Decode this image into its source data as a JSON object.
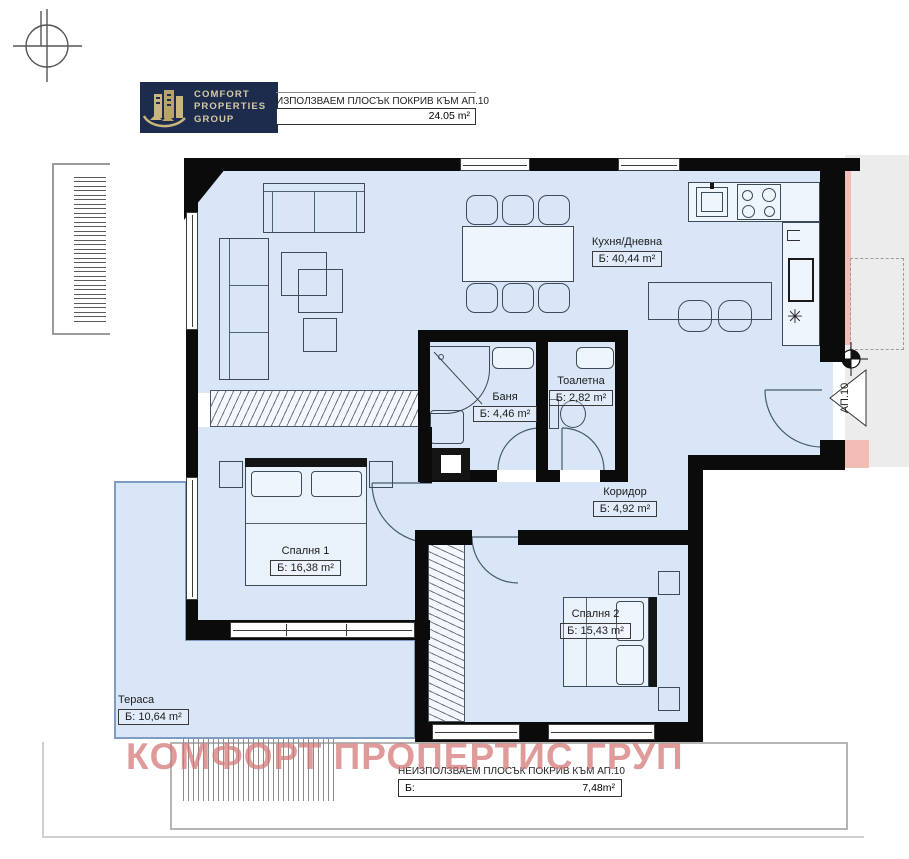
{
  "logo": {
    "line1": "COMFORT",
    "line2": "PROPERTIES",
    "line3": "GROUP",
    "bg": "#1d2b4d",
    "accent": "#c9b67e"
  },
  "roof_top": {
    "label": "ИЗПОЛЗВАЕМ ПЛОСЪК ПОКРИВ КЪМ АП.10",
    "area": "24.05 m²"
  },
  "roof_bottom": {
    "label": "НЕИЗПОЛЗВАЕМ ПЛОСЪК ПОКРИВ КЪМ АП.10",
    "prefix": "Б:",
    "area": "7,48m²"
  },
  "watermark": {
    "text": "КОМФОРТ ПРОПЕРТИС ГРУП",
    "color": "#d27373"
  },
  "apartment": {
    "tag": "АП.10"
  },
  "rooms": [
    {
      "id": "kitchen",
      "name": "Кухня/Дневна",
      "area": "Б: 40,44 m²"
    },
    {
      "id": "bath",
      "name": "Баня",
      "area": "Б: 4,46 m²"
    },
    {
      "id": "toilet",
      "name": "Тоалетна",
      "area": "Б: 2,82 m²"
    },
    {
      "id": "corridor",
      "name": "Коридор",
      "area": "Б: 4,92 m²"
    },
    {
      "id": "bedroom1",
      "name": "Спалня 1",
      "area": "Б: 16,38 m²"
    },
    {
      "id": "bedroom2",
      "name": "Спалня 2",
      "area": "Б: 15,43 m²"
    },
    {
      "id": "terrace",
      "name": "Тераса",
      "area": "Б: 10,64 m²"
    }
  ],
  "symbols": {
    "vent_asterisk": "✳"
  },
  "colors": {
    "room_fill": "#d8e6f7",
    "wall": "#0b0b0b",
    "counter": "#eef5fc",
    "corridor_gray": "#ececec",
    "pink": "#f3bdb6"
  }
}
